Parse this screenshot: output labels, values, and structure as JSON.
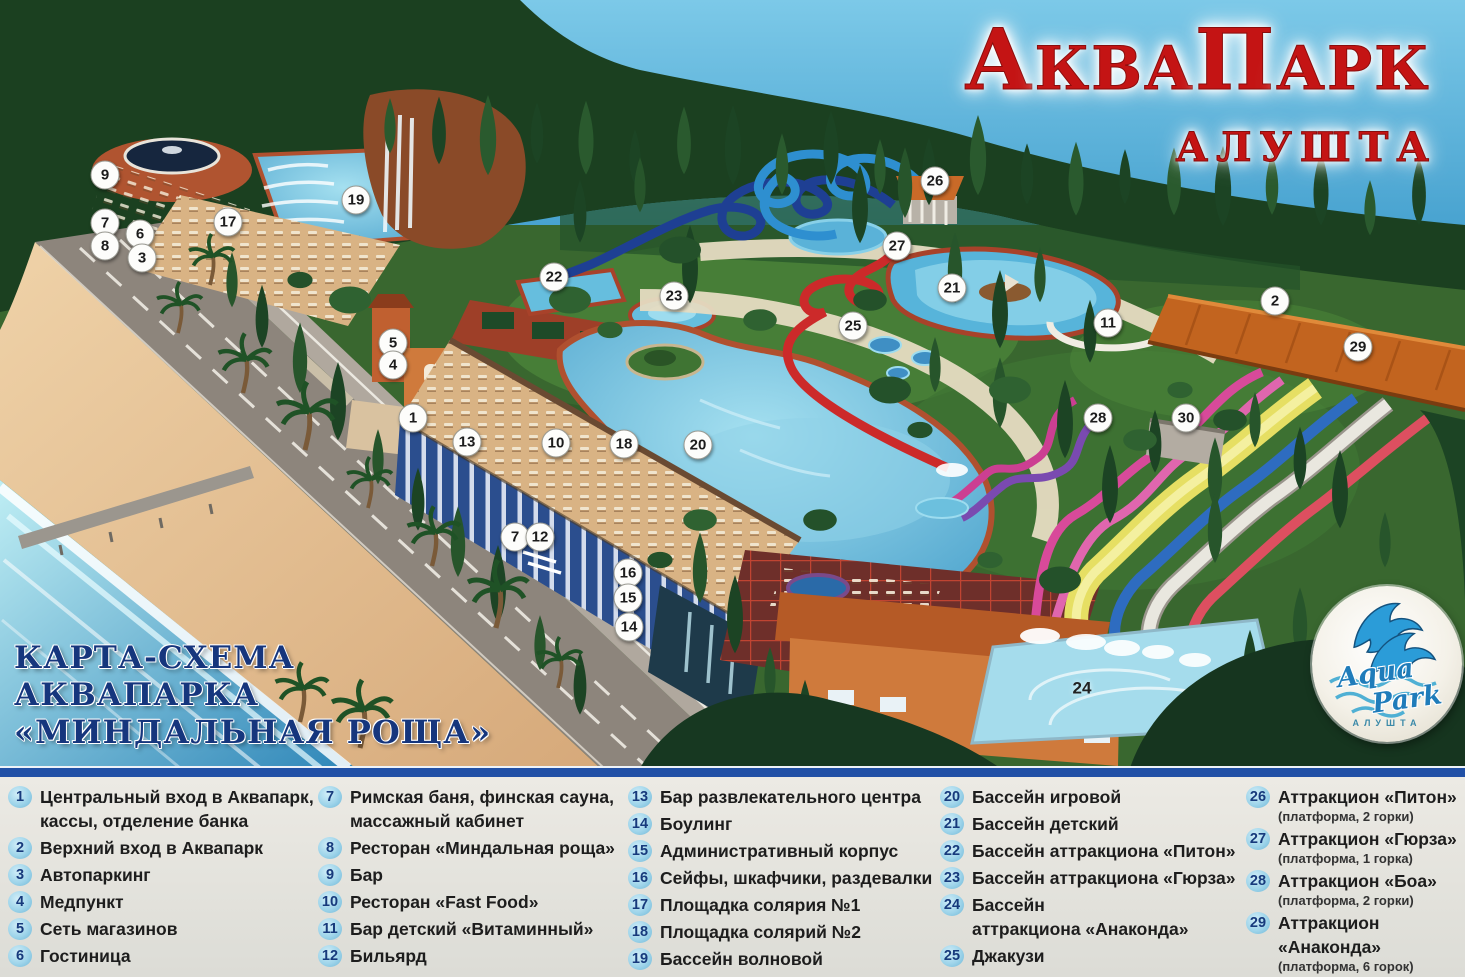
{
  "title": {
    "p1": "А",
    "p2": "КВА",
    "p3": "П",
    "p4": "АРК",
    "city": "АЛУШТА"
  },
  "caption": {
    "l1": "КАРТА-СХЕМА",
    "l2": "АКВАПАРКА",
    "l3": "«МИНДАЛЬНАЯ РОЩА»"
  },
  "logo": {
    "word1": "Aqua",
    "word2": "Park",
    "city": "АЛУШТА"
  },
  "colors": {
    "title_red": "#c41414",
    "caption_blue": "#16367d",
    "legend_badge": "#9ed4ea",
    "divider_blue": "#2150a6",
    "sky": "#3f9fce",
    "pool": "#5ab4d8"
  },
  "legend": {
    "columns": [
      {
        "items": [
          {
            "n": "1",
            "text": "Центральный вход в Аквапарк,\nкассы, отделение банка"
          },
          {
            "n": "2",
            "text": "Верхний вход в Аквапарк"
          },
          {
            "n": "3",
            "text": "Автопаркинг"
          },
          {
            "n": "4",
            "text": "Медпункт"
          },
          {
            "n": "5",
            "text": "Сеть магазинов"
          },
          {
            "n": "6",
            "text": "Гостиница"
          }
        ]
      },
      {
        "items": [
          {
            "n": "7",
            "text": "Римская баня, финская сауна,\nмассажный кабинет"
          },
          {
            "n": "8",
            "text": "Ресторан «Миндальная роща»"
          },
          {
            "n": "9",
            "text": "Бар"
          },
          {
            "n": "10",
            "text": "Ресторан «Fast Food»"
          },
          {
            "n": "11",
            "text": "Бар детский «Витаминный»"
          },
          {
            "n": "12",
            "text": "Бильярд"
          }
        ]
      },
      {
        "items": [
          {
            "n": "13",
            "text": "Бар развлекательного центра"
          },
          {
            "n": "14",
            "text": "Боулинг"
          },
          {
            "n": "15",
            "text": "Административный корпус"
          },
          {
            "n": "16",
            "text": "Сейфы, шкафчики, раздевалки"
          },
          {
            "n": "17",
            "text": "Площадка солярия №1"
          },
          {
            "n": "18",
            "text": "Площадка солярий №2"
          },
          {
            "n": "19",
            "text": "Бассейн волновой"
          }
        ]
      },
      {
        "items": [
          {
            "n": "20",
            "text": "Бассейн игровой"
          },
          {
            "n": "21",
            "text": "Бассейн детский"
          },
          {
            "n": "22",
            "text": "Бассейн аттракциона «Питон»"
          },
          {
            "n": "23",
            "text": "Бассейн аттракциона «Гюрза»"
          },
          {
            "n": "24",
            "text": "Бассейн\nаттракциона «Анаконда»"
          },
          {
            "n": "25",
            "text": "Джакузи"
          }
        ]
      },
      {
        "items": [
          {
            "n": "26",
            "text": "Аттракцион «Питон»",
            "note": "(платформа, 2 горки)"
          },
          {
            "n": "27",
            "text": "Аттракцион «Гюрза»",
            "note": "(платформа, 1 горка)"
          },
          {
            "n": "28",
            "text": "Аттракцион «Боа»",
            "note": "(платформа, 2 горки)"
          },
          {
            "n": "29",
            "text": "Аттракцион «Анаконда»",
            "note": "(платформа, 6 горок)"
          },
          {
            "n": "30",
            "text": "Туалет"
          }
        ]
      }
    ]
  },
  "map_markers": [
    {
      "n": "9",
      "x": 105,
      "y": 175
    },
    {
      "n": "7",
      "x": 105,
      "y": 223
    },
    {
      "n": "8",
      "x": 105,
      "y": 246
    },
    {
      "n": "6",
      "x": 140,
      "y": 234
    },
    {
      "n": "3",
      "x": 142,
      "y": 258
    },
    {
      "n": "17",
      "x": 228,
      "y": 222
    },
    {
      "n": "19",
      "x": 356,
      "y": 200
    },
    {
      "n": "22",
      "x": 554,
      "y": 277
    },
    {
      "n": "23",
      "x": 674,
      "y": 296
    },
    {
      "n": "26",
      "x": 935,
      "y": 181
    },
    {
      "n": "27",
      "x": 897,
      "y": 246
    },
    {
      "n": "21",
      "x": 952,
      "y": 288
    },
    {
      "n": "25",
      "x": 853,
      "y": 326
    },
    {
      "n": "11",
      "x": 1108,
      "y": 323
    },
    {
      "n": "2",
      "x": 1275,
      "y": 301
    },
    {
      "n": "29",
      "x": 1358,
      "y": 347
    },
    {
      "n": "5",
      "x": 393,
      "y": 343
    },
    {
      "n": "4",
      "x": 393,
      "y": 365
    },
    {
      "n": "1",
      "x": 413,
      "y": 418
    },
    {
      "n": "13",
      "x": 467,
      "y": 442
    },
    {
      "n": "10",
      "x": 556,
      "y": 443
    },
    {
      "n": "18",
      "x": 624,
      "y": 444
    },
    {
      "n": "20",
      "x": 698,
      "y": 445
    },
    {
      "n": "28",
      "x": 1098,
      "y": 418
    },
    {
      "n": "30",
      "x": 1186,
      "y": 418
    },
    {
      "n": "7",
      "x": 515,
      "y": 537
    },
    {
      "n": "12",
      "x": 540,
      "y": 537
    },
    {
      "n": "16",
      "x": 628,
      "y": 573
    },
    {
      "n": "15",
      "x": 628,
      "y": 598
    },
    {
      "n": "14",
      "x": 629,
      "y": 627
    },
    {
      "n": "24",
      "x": 1082,
      "y": 688,
      "plain": true
    }
  ]
}
